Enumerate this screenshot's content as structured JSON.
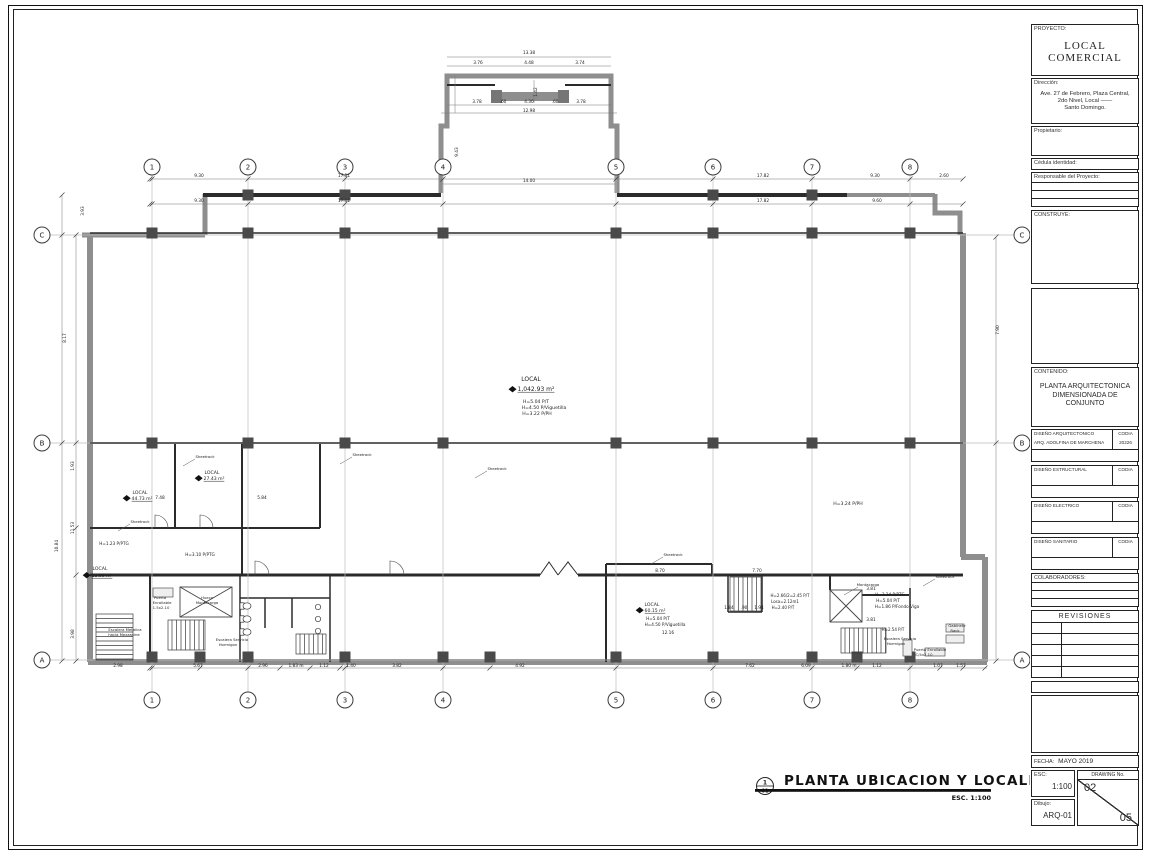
{
  "sheet": {
    "drawing_title": "PLANTA  UBICACION  Y  LOCALIZACION",
    "drawing_scale": "ESC.  1:100",
    "title_ref_top": "1",
    "title_ref_bottom": "01"
  },
  "title_block": {
    "proyecto_label": "PROYECTO:",
    "proyecto_line1": "LOCAL",
    "proyecto_line2": "COMERCIAL",
    "direccion_label": "Dirección:",
    "direccion_line1": "Ave. 27 de Febrero, Plaza Central,",
    "direccion_line2": "2do Nivel, Local  ——",
    "direccion_line3": "Santo Domingo.",
    "propietario_label": "Propietario:",
    "cedula_label": "Cédula identidad:",
    "responsable_label": "Responsable del Proyecto:",
    "construye_label": "CONSTRUYE:",
    "contenido_label": "CONTENIDO:",
    "contenido_line1": "PLANTA ARQUITECTONICA",
    "contenido_line2": "DIMENSIONADA DE",
    "contenido_line3": "CONJUNTO",
    "sections": [
      {
        "name": "DISEÑO ARQUITECTONICO",
        "codia_label": "CODIA",
        "row_name": "ARQ. ADOLFINA DE MARCHENA",
        "row_codia": "20226"
      },
      {
        "name": "DISEÑO ESTRUCTURAL",
        "codia_label": "CODIA",
        "row_name": "",
        "row_codia": ""
      },
      {
        "name": "DISEÑO ELECTRICO",
        "codia_label": "CODIA",
        "row_name": "",
        "row_codia": ""
      },
      {
        "name": "DISEÑO SANITARIO",
        "codia_label": "CODIA",
        "row_name": "",
        "row_codia": ""
      }
    ],
    "colaboradores_label": "COLABORADORES:",
    "revisiones_label": "REVISIONES",
    "fecha_label": "FECHA:",
    "fecha": "MAYO 2019",
    "esc_label": "ESC:",
    "esc": "1:100",
    "dibujo_label": "Dibujo:",
    "dibujo": "ARQ-01",
    "drawing_no_label": "DRAWING No.",
    "drawing_no": "02",
    "drawing_total": "05"
  },
  "plan": {
    "grid_cols": [
      {
        "label": "1",
        "x": 152
      },
      {
        "label": "2",
        "x": 248
      },
      {
        "label": "3",
        "x": 345
      },
      {
        "label": "4",
        "x": 443
      },
      {
        "label": "5",
        "x": 616
      },
      {
        "label": "6",
        "x": 713
      },
      {
        "label": "7",
        "x": 812
      },
      {
        "label": "8",
        "x": 910
      }
    ],
    "grid_rows": [
      {
        "label": "C",
        "y": 235
      },
      {
        "label": "B",
        "y": 443
      },
      {
        "label": "A",
        "y": 660
      }
    ],
    "labels": [
      {
        "t": "LOCAL",
        "x": 531,
        "y": 381,
        "fs": 6
      },
      {
        "t": "1,042.93 m²",
        "x": 536,
        "y": 391,
        "fs": 6,
        "u": 1,
        "d": 1
      },
      {
        "t": "H=5.04 P/T",
        "x": 536,
        "y": 403,
        "fs": 4.6
      },
      {
        "t": "H=4.50 P/Viguetilla",
        "x": 544,
        "y": 409,
        "fs": 4.6
      },
      {
        "t": "H=3.22 P/PH",
        "x": 537,
        "y": 415,
        "fs": 4.6
      },
      {
        "t": "LOCAL",
        "x": 140,
        "y": 494,
        "fs": 4.6
      },
      {
        "t": "44.73 m²",
        "x": 142,
        "y": 500,
        "fs": 4.6,
        "u": 1,
        "d": 1
      },
      {
        "t": "LOCAL",
        "x": 212,
        "y": 474,
        "fs": 4.6
      },
      {
        "t": "27.43 m²",
        "x": 214,
        "y": 480,
        "fs": 4.6,
        "u": 1,
        "d": 1
      },
      {
        "t": "H=1.23 P/PTG",
        "x": 114,
        "y": 545,
        "fs": 4.2
      },
      {
        "t": "LOCAL",
        "x": 100,
        "y": 570,
        "fs": 4.6
      },
      {
        "t": "13.99 m²",
        "x": 102,
        "y": 577,
        "fs": 4.6,
        "u": 1,
        "d": 1
      },
      {
        "t": "H=3.10 P/PTG",
        "x": 200,
        "y": 556,
        "fs": 4.2
      },
      {
        "t": "H=3.24 P/PH",
        "x": 848,
        "y": 505,
        "fs": 4.6
      },
      {
        "t": "LOCAL",
        "x": 652,
        "y": 606,
        "fs": 4.6
      },
      {
        "t": "60.15 m²",
        "x": 655,
        "y": 612,
        "fs": 4.6,
        "u": 1,
        "d": 1
      },
      {
        "t": "H=5.04 P/T",
        "x": 658,
        "y": 620,
        "fs": 4.2
      },
      {
        "t": "H=4.50 P/Viguetilla",
        "x": 665,
        "y": 626,
        "fs": 4.2
      },
      {
        "t": "H=3.24 P/PTG",
        "x": 890,
        "y": 596,
        "fs": 4.2
      },
      {
        "t": "H=5.04 P/T",
        "x": 888,
        "y": 602,
        "fs": 4.2
      },
      {
        "t": "H=1.86 P/Fondo Viga",
        "x": 897,
        "y": 608,
        "fs": 4.2
      },
      {
        "t": "H=2.66/2=2.45 P/T",
        "x": 790,
        "y": 597,
        "fs": 4
      },
      {
        "t": "Losa=2.12m1",
        "x": 785,
        "y": 603,
        "fs": 4
      },
      {
        "t": "H=2.40 P/T",
        "x": 783,
        "y": 609,
        "fs": 4
      },
      {
        "t": "H=2.54 P/T",
        "x": 893,
        "y": 631,
        "fs": 4
      },
      {
        "t": "Hueco",
        "x": 207,
        "y": 599,
        "fs": 3.8
      },
      {
        "t": "Montacarga",
        "x": 207,
        "y": 604,
        "fs": 3.8
      },
      {
        "t": "Montacarga",
        "x": 868,
        "y": 586,
        "fs": 3.8
      },
      {
        "t": "Escalera Metalica",
        "x": 125,
        "y": 631,
        "fs": 3.8
      },
      {
        "t": "hacia Mezzanine",
        "x": 124,
        "y": 636,
        "fs": 3.8
      },
      {
        "t": "Escalera Servicio",
        "x": 232,
        "y": 641,
        "fs": 3.8
      },
      {
        "t": "Hormigon",
        "x": 228,
        "y": 646,
        "fs": 3.8
      },
      {
        "t": "Escalera Servicio",
        "x": 900,
        "y": 640,
        "fs": 3.8
      },
      {
        "t": "Hormigon",
        "x": 896,
        "y": 645,
        "fs": 3.8
      },
      {
        "t": "Puerta",
        "x": 160,
        "y": 599,
        "fs": 3.8
      },
      {
        "t": "Enrollable",
        "x": 162,
        "y": 604,
        "fs": 3.8
      },
      {
        "t": "1.5x2.10",
        "x": 161,
        "y": 609,
        "fs": 3.8
      },
      {
        "t": "Puerta Enrollable",
        "x": 930,
        "y": 651,
        "fs": 3.8
      },
      {
        "t": "C/4x2.10",
        "x": 924,
        "y": 656,
        "fs": 3.8
      },
      {
        "t": "Gabinete",
        "x": 957,
        "y": 627,
        "fs": 3.8
      },
      {
        "t": "Rack",
        "x": 955,
        "y": 632,
        "fs": 3.8
      },
      {
        "t": "Sheetrock",
        "x": 205,
        "y": 458,
        "fs": 3.8
      },
      {
        "t": "Sheetrock",
        "x": 362,
        "y": 456,
        "fs": 3.8
      },
      {
        "t": "Sheetrock",
        "x": 497,
        "y": 470,
        "fs": 3.8
      },
      {
        "t": "Sheetrock",
        "x": 140,
        "y": 523,
        "fs": 3.8
      },
      {
        "t": "Sheetrock",
        "x": 673,
        "y": 556,
        "fs": 3.8
      },
      {
        "t": "Sheetrock",
        "x": 945,
        "y": 578,
        "fs": 3.8
      }
    ],
    "dims": [
      {
        "t": "13.38",
        "x": 529,
        "y": 54
      },
      {
        "t": "3.76",
        "x": 478,
        "y": 64
      },
      {
        "t": "4.48",
        "x": 529,
        "y": 64
      },
      {
        "t": "3.74",
        "x": 580,
        "y": 64
      },
      {
        "t": "1.42",
        "x": 537,
        "y": 92,
        "r": 1
      },
      {
        "t": "3.78",
        "x": 477,
        "y": 103
      },
      {
        "t": ".60",
        "x": 503,
        "y": 103
      },
      {
        "t": "4.30",
        "x": 529,
        "y": 103
      },
      {
        "t": ".60",
        "x": 555,
        "y": 103
      },
      {
        "t": "3.78",
        "x": 581,
        "y": 103
      },
      {
        "t": "12.98",
        "x": 529,
        "y": 112
      },
      {
        "t": "14.00",
        "x": 529,
        "y": 182
      },
      {
        "t": "9.43",
        "x": 458,
        "y": 152,
        "r": 1
      },
      {
        "t": "9.30",
        "x": 199,
        "y": 177
      },
      {
        "t": "17.11",
        "x": 344,
        "y": 177
      },
      {
        "t": "17.82",
        "x": 763,
        "y": 177
      },
      {
        "t": "9.30",
        "x": 875,
        "y": 177
      },
      {
        "t": "2.60",
        "x": 944,
        "y": 177
      },
      {
        "t": "9.30",
        "x": 199,
        "y": 202
      },
      {
        "t": "17.11",
        "x": 344,
        "y": 202
      },
      {
        "t": "17.82",
        "x": 763,
        "y": 202
      },
      {
        "t": "9.60",
        "x": 877,
        "y": 202
      },
      {
        "t": "3.93",
        "x": 84,
        "y": 211,
        "r": 1
      },
      {
        "t": "8.17",
        "x": 66,
        "y": 338,
        "r": 1
      },
      {
        "t": "1.93",
        "x": 74,
        "y": 466,
        "r": 1
      },
      {
        "t": "11.53",
        "x": 74,
        "y": 528,
        "r": 1
      },
      {
        "t": "10.84",
        "x": 58,
        "y": 546,
        "r": 1
      },
      {
        "t": "3.98",
        "x": 74,
        "y": 634,
        "r": 1
      },
      {
        "t": "7.90",
        "x": 999,
        "y": 330,
        "r": 1
      },
      {
        "t": "7.48",
        "x": 160,
        "y": 499
      },
      {
        "t": "5.84",
        "x": 262,
        "y": 499
      },
      {
        "t": "8.70",
        "x": 660,
        "y": 572
      },
      {
        "t": "7.70",
        "x": 757,
        "y": 572
      },
      {
        "t": "1.84",
        "x": 729,
        "y": 609
      },
      {
        "t": ".90",
        "x": 744,
        "y": 609
      },
      {
        "t": "1.94",
        "x": 759,
        "y": 609
      },
      {
        "t": "12.16",
        "x": 668,
        "y": 634
      },
      {
        "t": "3.81",
        "x": 871,
        "y": 590
      },
      {
        "t": "3.81",
        "x": 871,
        "y": 621
      },
      {
        "t": "2.98",
        "x": 118,
        "y": 667
      },
      {
        "t": "5.67",
        "x": 198,
        "y": 667
      },
      {
        "t": "2.96",
        "x": 263,
        "y": 667
      },
      {
        "t": "1.83 m",
        "x": 296,
        "y": 667
      },
      {
        "t": "1.12",
        "x": 324,
        "y": 667
      },
      {
        "t": "1.40",
        "x": 351,
        "y": 667
      },
      {
        "t": "3.82",
        "x": 397,
        "y": 667
      },
      {
        "t": "4.92",
        "x": 520,
        "y": 667
      },
      {
        "t": "7.62",
        "x": 750,
        "y": 667
      },
      {
        "t": "6.09",
        "x": 806,
        "y": 667
      },
      {
        "t": "1.80 m",
        "x": 849,
        "y": 667
      },
      {
        "t": "1.12",
        "x": 877,
        "y": 667
      },
      {
        "t": "1.07",
        "x": 938,
        "y": 667
      },
      {
        "t": "1.57",
        "x": 961,
        "y": 667
      }
    ]
  }
}
